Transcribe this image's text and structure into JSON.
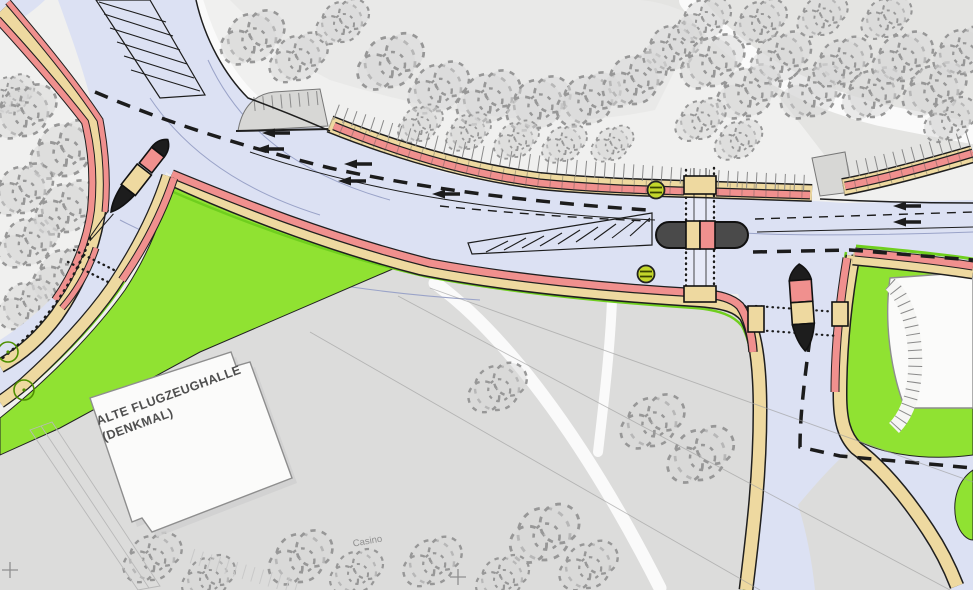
{
  "map": {
    "type": "traffic-engineering-site-plan",
    "labels": {
      "building_line1": "ALTE FLUGZEUGHALLE",
      "building_line2": "(DENKMAL)",
      "casino": "Casino"
    },
    "features": {
      "traffic_signal_count": 2,
      "pedestrian_islands": 3,
      "survey_cross_count": 2,
      "legend_semantics": {
        "blue": "roadway",
        "red": "cycle track",
        "yellow": "footway / sidewalk",
        "bright_green": "grass verge",
        "gray": "existing paved / building area",
        "dark_pill": "median refuge island"
      }
    }
  },
  "palette": {
    "bgLight": "#f0f0ef",
    "grayMid": "#e4e4e2",
    "grayBottom": "#dcdcdb",
    "grayBay": "#d7d7d5",
    "white": "#fafafa",
    "road": "#dce1f3",
    "roadLight": "#e7eaf8",
    "roadEdge": "#1f1f1f",
    "walk": "#eed9a0",
    "bike": "#f0908e",
    "green": "#90e232",
    "greenEdge": "#222222",
    "limeStrip": "#6fcf1e",
    "island": "#4a4a4a",
    "signal": "#c3d62b",
    "treeFill": "#d8d8d8",
    "treeStroke": "#979797",
    "marking": "#1c1c1c",
    "guide": "#9aa3c8",
    "surveyLine": "#9e9e9e",
    "buildingFill": "#fbfbfa",
    "buildingStroke": "#8e8e8e",
    "labelDark": "#4f4f4f",
    "labelLight": "#8f8f8f",
    "plantedTree": "#4e8f00"
  }
}
